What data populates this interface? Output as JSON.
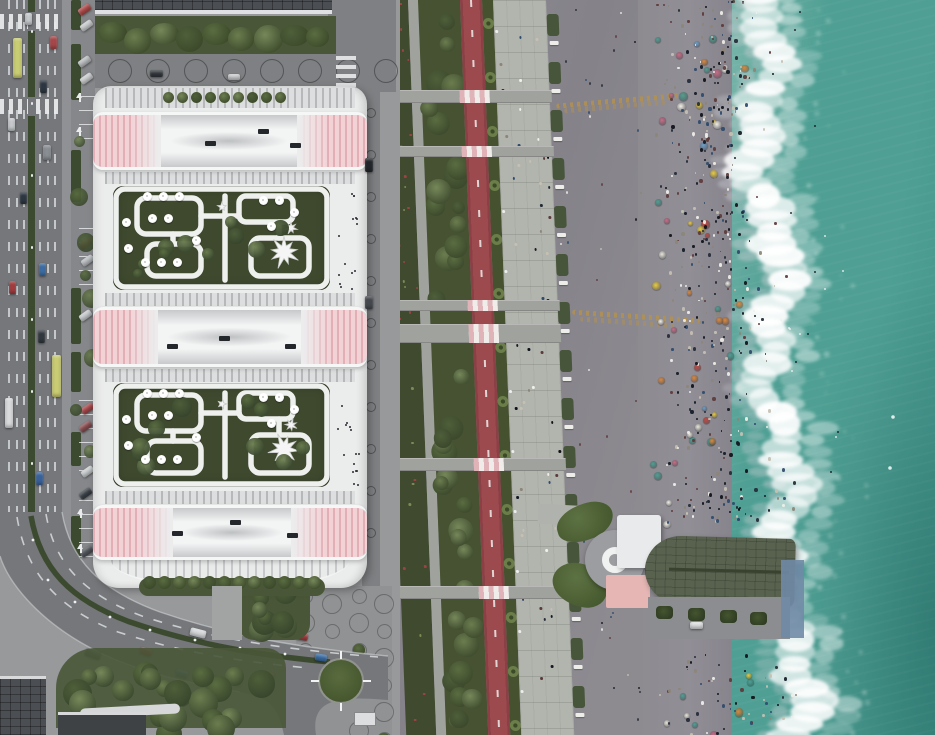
{
  "meta": {
    "title": "aerial-seafront-resort-render",
    "width": 935,
    "height": 735
  },
  "colors": {
    "ground": "#97999b",
    "road": "#75777a",
    "roadLight": "#7e8083",
    "lane": "#d9dcde",
    "hedge": "#3c4a30",
    "sidewalk": "#8f9194",
    "parking": "#85878a",
    "plazaC": "#909294",
    "circlePit": "#6f7174",
    "buildingWhite": "#ebecec",
    "stripeLight": "#dcdedf",
    "stripeDark": "#b6b8ba",
    "pink": "#f3d2d6",
    "pinkDark": "#e2afb6",
    "roofGarden": "#3e492e",
    "pathWhite": "#eff0ef",
    "treeD": "#465231",
    "tree1": "#5a6d41",
    "tree2": "#6b7d4f",
    "tree3": "#76885a",
    "topTreeBase": "#495637",
    "flowerbed": "#3f4a2e",
    "gpath": "#a0a29e",
    "redPath": "#9d4a4e",
    "redPathDark": "#8a4045",
    "palmStrip": "#45512f",
    "promenade": "#b2b4ae",
    "benchGreen": "#47553a",
    "bench": "#edeeea",
    "apron": "#8d8b90",
    "apronDark": "#85828a",
    "wetSand": "#7e7b84",
    "beach": "#918e96",
    "seaNear": "#79b5aa",
    "sea": "#4f9f94",
    "seaDeep": "#3f9187",
    "streak": "#b3914f",
    "pierLeaf": "#50633a",
    "pierCircle": "#9b9da1",
    "pierWhiteRoof": "#e9eaeb",
    "pierPink": "#e5b6b4",
    "pierRoofD": "#59624f",
    "deck": "#8b8d90",
    "blueDeck": "#7089a6",
    "kiosk": "#dcdedf",
    "darkBldg": "#4b4e52",
    "darkBldg2": "#3f4245",
    "flower": "#9c4343"
  },
  "regions": [
    "city-road",
    "resort-building",
    "roof-gardens",
    "linear-park",
    "bike-path",
    "promenade",
    "beach-apron",
    "beach-crowd",
    "surf",
    "sea",
    "pier-pavilion",
    "plaza"
  ],
  "building": {
    "x": 93,
    "y": 86,
    "w": 274,
    "h": 502,
    "bands": [
      {
        "y": 112,
        "h": 58,
        "leftW": 68,
        "rightW": 70,
        "vents": [
          [
            112,
            26
          ],
          [
            165,
            14
          ],
          [
            197,
            28
          ]
        ]
      },
      {
        "y": 307,
        "h": 60,
        "leftW": 65,
        "rightW": 66,
        "vents": [
          [
            74,
            34
          ],
          [
            126,
            26
          ],
          [
            192,
            34
          ]
        ]
      },
      {
        "y": 505,
        "h": 55,
        "leftW": 80,
        "rightW": 76,
        "vents": [
          [
            79,
            23
          ],
          [
            137,
            12
          ],
          [
            194,
            25
          ]
        ]
      }
    ],
    "stripe_rows": [
      [
        2,
        20
      ],
      [
        86,
        12
      ],
      [
        207,
        13
      ],
      [
        283,
        13
      ],
      [
        405,
        13
      ]
    ],
    "gardens": [
      {
        "y": 186
      },
      {
        "y": 383
      }
    ],
    "garden_size": {
      "x": 113,
      "w": 217,
      "h": 104
    },
    "umbrellas": [
      [
        34,
        10
      ],
      [
        50,
        10
      ],
      [
        66,
        10
      ],
      [
        39,
        32
      ],
      [
        55,
        32
      ],
      [
        32,
        76
      ],
      [
        48,
        76
      ],
      [
        64,
        76
      ],
      [
        83,
        54
      ],
      [
        13,
        36
      ],
      [
        15,
        62
      ],
      [
        150,
        14
      ],
      [
        166,
        14
      ],
      [
        181,
        26
      ],
      [
        158,
        40
      ]
    ],
    "stars": [
      {
        "cx": 171,
        "cy": 66,
        "R": 15,
        "r": 6.5,
        "n": 9
      },
      {
        "cx": 178,
        "cy": 42,
        "R": 6,
        "r": 2.5,
        "n": 7
      },
      {
        "cx": 109,
        "cy": 21,
        "R": 4.5,
        "r": 2,
        "n": 5
      }
    ]
  },
  "park": {
    "skew_deg": 2.2,
    "crossings": [
      {
        "y": 90,
        "h": 13
      },
      {
        "y": 146,
        "h": 11
      },
      {
        "y": 300,
        "h": 11
      },
      {
        "y": 324,
        "h": 19
      },
      {
        "y": 458,
        "h": 13
      },
      {
        "y": 586,
        "h": 13
      }
    ],
    "tree_seed": 5,
    "tree_count": 40,
    "flower_count": 42,
    "palm_step": 54
  },
  "left_road": {
    "zebras": [
      14,
      99
    ],
    "cars": [
      {
        "x": 8,
        "y": 118,
        "w": 7,
        "h": 13,
        "c": "#c7cacd"
      },
      {
        "x": 9,
        "y": 281,
        "w": 7,
        "h": 13,
        "c": "#a33c3f"
      },
      {
        "x": 20,
        "y": 192,
        "w": 7,
        "h": 12,
        "c": "#2e3742"
      },
      {
        "x": 40,
        "y": 80,
        "w": 7,
        "h": 13,
        "c": "#2e3742"
      },
      {
        "x": 50,
        "y": 36,
        "w": 7,
        "h": 13,
        "c": "#a8484b"
      },
      {
        "x": 39,
        "y": 263,
        "w": 7,
        "h": 13,
        "c": "#3c6ea5"
      },
      {
        "x": 36,
        "y": 472,
        "w": 7,
        "h": 13,
        "c": "#3a639c"
      },
      {
        "x": 38,
        "y": 330,
        "w": 7,
        "h": 13,
        "c": "#31393f"
      },
      {
        "x": 25,
        "y": 13,
        "w": 7,
        "h": 12,
        "c": "#c7cacd"
      },
      {
        "x": 43,
        "y": 145,
        "w": 8,
        "h": 15,
        "c": "#8a8f94"
      }
    ],
    "buses": [
      {
        "x": 13,
        "y": 38,
        "w": 9,
        "h": 40,
        "c": "#c9cc72"
      },
      {
        "x": 52,
        "y": 355,
        "w": 9,
        "h": 42,
        "c": "#c9cc72"
      },
      {
        "x": 5,
        "y": 398,
        "w": 8,
        "h": 30,
        "c": "#d8dadc"
      }
    ],
    "hedge_patches": [
      [
        0,
        30
      ],
      [
        44,
        56
      ],
      [
        150,
        52
      ],
      [
        288,
        56
      ],
      [
        352,
        40
      ],
      [
        432,
        34
      ],
      [
        516,
        44
      ],
      [
        572,
        26
      ]
    ],
    "stall_rows": [
      [
        96,
        46
      ],
      [
        228,
        66
      ],
      [
        400,
        78
      ],
      [
        500,
        60
      ]
    ],
    "parked": [
      {
        "x": 78,
        "y": 6,
        "c": "#b04a4a"
      },
      {
        "x": 80,
        "y": 22,
        "c": "#c8cbcd"
      },
      {
        "x": 78,
        "y": 58,
        "c": "#babdbf"
      },
      {
        "x": 80,
        "y": 75,
        "c": "#caccce"
      },
      {
        "x": 79,
        "y": 240,
        "c": "#a8484b"
      },
      {
        "x": 81,
        "y": 257,
        "c": "#b8bcc0"
      },
      {
        "x": 79,
        "y": 312,
        "c": "#c7cacd"
      },
      {
        "x": 81,
        "y": 405,
        "c": "#a8484b"
      },
      {
        "x": 79,
        "y": 423,
        "c": "#8b4f52"
      },
      {
        "x": 81,
        "y": 468,
        "c": "#c9ccce"
      },
      {
        "x": 79,
        "y": 490,
        "c": "#3a4148"
      },
      {
        "x": 80,
        "y": 548,
        "c": "#53575c"
      }
    ],
    "arrows": [
      [
        79,
        90
      ],
      [
        79,
        124
      ],
      [
        80,
        506
      ],
      [
        80,
        541
      ]
    ]
  },
  "top_street": {
    "pit_start": 108,
    "pit_step": 38,
    "pit_count": 8,
    "cars": [
      {
        "x": 150,
        "y": 70,
        "w": 13,
        "h": 7,
        "c": "#33383d"
      },
      {
        "x": 228,
        "y": 74,
        "w": 12,
        "h": 6,
        "c": "#c9ccce"
      }
    ]
  },
  "service_road": {
    "cars": [
      {
        "x": 365,
        "y": 158,
        "w": 8,
        "h": 14,
        "c": "#23272c"
      },
      {
        "x": 365,
        "y": 296,
        "w": 8,
        "h": 13,
        "c": "#45494e"
      }
    ]
  },
  "diag_road": {
    "cars": [
      {
        "x": 85,
        "y": 650,
        "w": 16,
        "h": 8,
        "rot": 20,
        "c": "#5a5e63"
      },
      {
        "x": 140,
        "y": 648,
        "w": 12,
        "h": 7,
        "rot": 17,
        "c": "#a33c3f"
      },
      {
        "x": 190,
        "y": 629,
        "w": 16,
        "h": 8,
        "rot": 14,
        "c": "#d5d7d9"
      },
      {
        "x": 242,
        "y": 621,
        "w": 15,
        "h": 8,
        "rot": 12,
        "c": "#d5d7d9"
      },
      {
        "x": 296,
        "y": 633,
        "w": 12,
        "h": 7,
        "rot": 10,
        "c": "#a33c3f"
      },
      {
        "x": 315,
        "y": 654,
        "w": 12,
        "h": 7,
        "rot": 9,
        "c": "#3c6ea5"
      },
      {
        "x": 176,
        "y": 670,
        "w": 12,
        "h": 7,
        "rot": 15,
        "c": "#3c6ea5"
      },
      {
        "x": 204,
        "y": 674,
        "w": 12,
        "h": 7,
        "rot": 13,
        "c": "#27304a"
      },
      {
        "x": 228,
        "y": 677,
        "w": 13,
        "h": 7,
        "rot": 12,
        "c": "#33373c"
      },
      {
        "x": 262,
        "y": 672,
        "w": 12,
        "h": 7,
        "rot": 11,
        "c": "#a33c3f"
      }
    ],
    "hedge_posts": [
      [
        33,
        540
      ],
      [
        48,
        580
      ],
      [
        75,
        602
      ],
      [
        110,
        617
      ],
      [
        150,
        630
      ],
      [
        195,
        640
      ],
      [
        240,
        648
      ],
      [
        285,
        654
      ],
      [
        322,
        659
      ]
    ]
  },
  "plaza": {
    "cols": [
      305,
      332,
      359,
      384
    ],
    "row_start": 596,
    "row_step": 27,
    "rows": 6,
    "green": {
      "x": 318,
      "y": 658,
      "d": 46
    }
  },
  "beach": {
    "seed": 11,
    "people": 560,
    "umbrellas": 74,
    "swimmers": 24,
    "apron_people": 42,
    "prom_people": 58,
    "umbrella_colors": [
      "#e8cb43",
      "#f1efe7",
      "#c04a44",
      "#4f9f94",
      "#d9893f",
      "#c76d88",
      "#6f9fc9",
      "#e8e6da"
    ],
    "people_colors": [
      "#141a24",
      "#232a36",
      "#f0efe9",
      "#c6c0b2",
      "#5c3a3a",
      "#2e4a6b",
      "#8c8578",
      "#0e1118"
    ],
    "boats": [
      [
        893,
        417
      ],
      [
        890,
        468
      ]
    ]
  },
  "streaks": [
    {
      "x": 556,
      "y": 98,
      "w": 132,
      "rot": -5
    },
    {
      "x": 572,
      "y": 314,
      "w": 128,
      "rot": 4
    }
  ],
  "promenade": {
    "bench_step": 48
  },
  "pier": {
    "leaf1": {
      "x": 556,
      "y": 504,
      "w": 58,
      "h": 36,
      "rot": -16
    },
    "leaf2": {
      "x": 552,
      "y": 564,
      "w": 56,
      "h": 42,
      "rot": 14
    },
    "circle": {
      "x": 585,
      "y": 530,
      "d": 60
    },
    "white_roof": {
      "x": 617,
      "y": 515,
      "w": 44,
      "h": 53
    },
    "pink_roof": {
      "x": 606,
      "y": 575,
      "w": 44,
      "h": 33
    },
    "pavilion": {
      "x": 645,
      "y": 537,
      "w": 150,
      "h": 68,
      "rot": 1.5
    },
    "deck": {
      "x": 648,
      "y": 597,
      "w": 142,
      "h": 42
    },
    "bushes": [
      [
        656,
        606
      ],
      [
        688,
        608
      ],
      [
        720,
        610
      ],
      [
        750,
        612
      ]
    ],
    "car": {
      "x": 690,
      "y": 622,
      "w": 13,
      "h": 7
    },
    "blue_deck": {
      "x": 781,
      "y": 560,
      "w": 23,
      "h": 78
    },
    "walk": {
      "x": 538,
      "y": 505,
      "w": 52,
      "h": 20
    }
  },
  "bottom": {
    "bldg1": {
      "x": 0,
      "y": 676,
      "w": 46,
      "h": 59
    },
    "bldg2": {
      "x": 58,
      "y": 712,
      "w": 88,
      "h": 23
    },
    "white_band": {
      "x": 80,
      "y": 706,
      "w": 100,
      "h": 10
    },
    "kiosk": {
      "x": 354,
      "y": 712,
      "w": 22,
      "h": 14
    },
    "walkway": {
      "x": 212,
      "y": 586,
      "w": 30,
      "h": 54
    }
  }
}
